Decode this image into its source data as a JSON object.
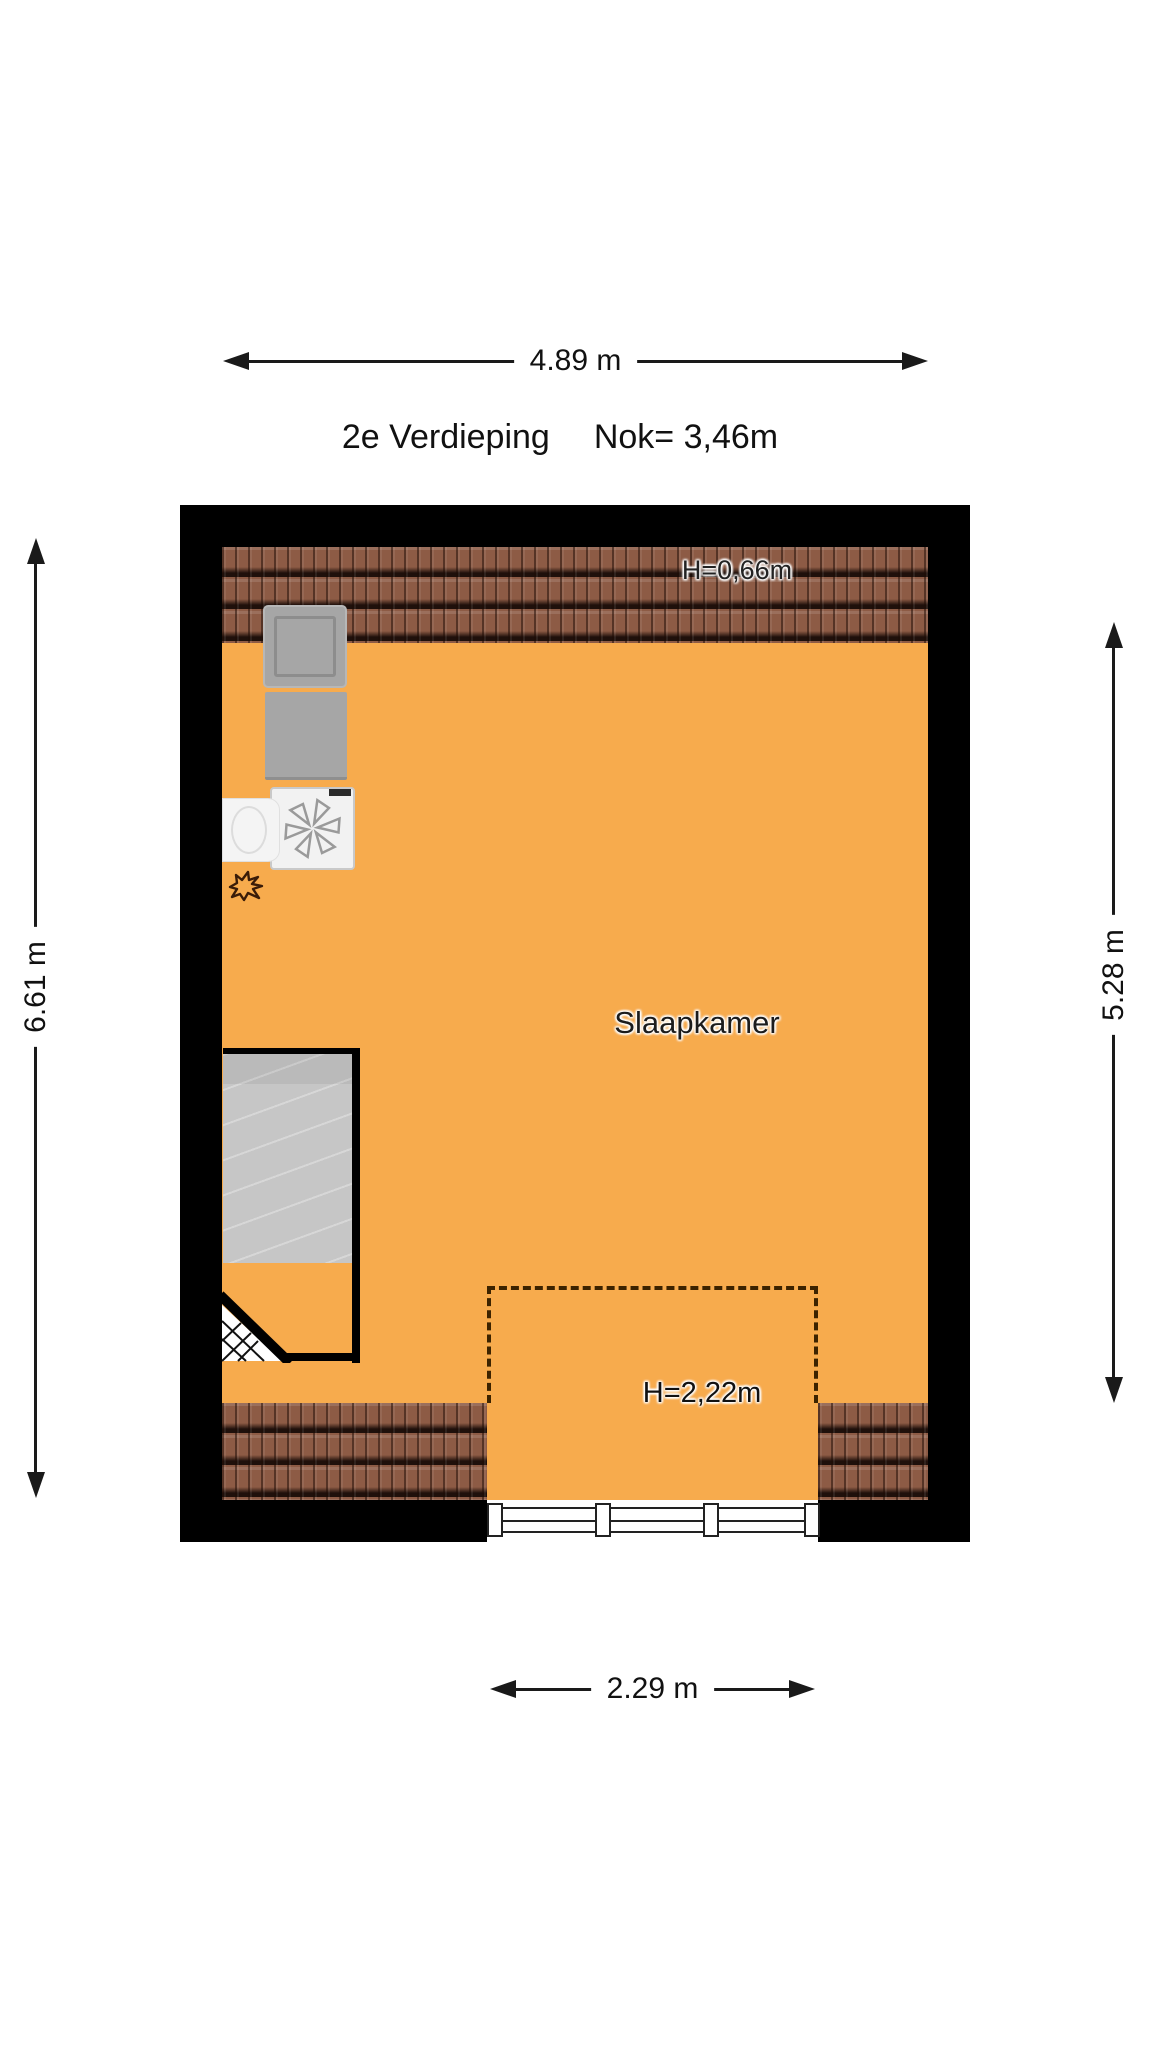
{
  "title": {
    "floor_label": "2e Verdieping",
    "ridge_label": "Nok= 3,46m"
  },
  "room_label": "Slaapkamer",
  "dimension_labels": {
    "top": "4.89 m",
    "left": "6.61 m",
    "right": "5.28 m",
    "bottom": "2.29 m"
  },
  "height_labels": {
    "knee_wall": "H=0,66m",
    "dormer": "H=2,22m"
  },
  "colors": {
    "floor": "#F7AB4D",
    "wall": "#000000",
    "roof_tile": "#8D5B45",
    "stair": "#C6C6C6",
    "appliance": "#A6A6A6",
    "dashed_line": "#3C2300",
    "dim_line": "#1A1A1A"
  }
}
